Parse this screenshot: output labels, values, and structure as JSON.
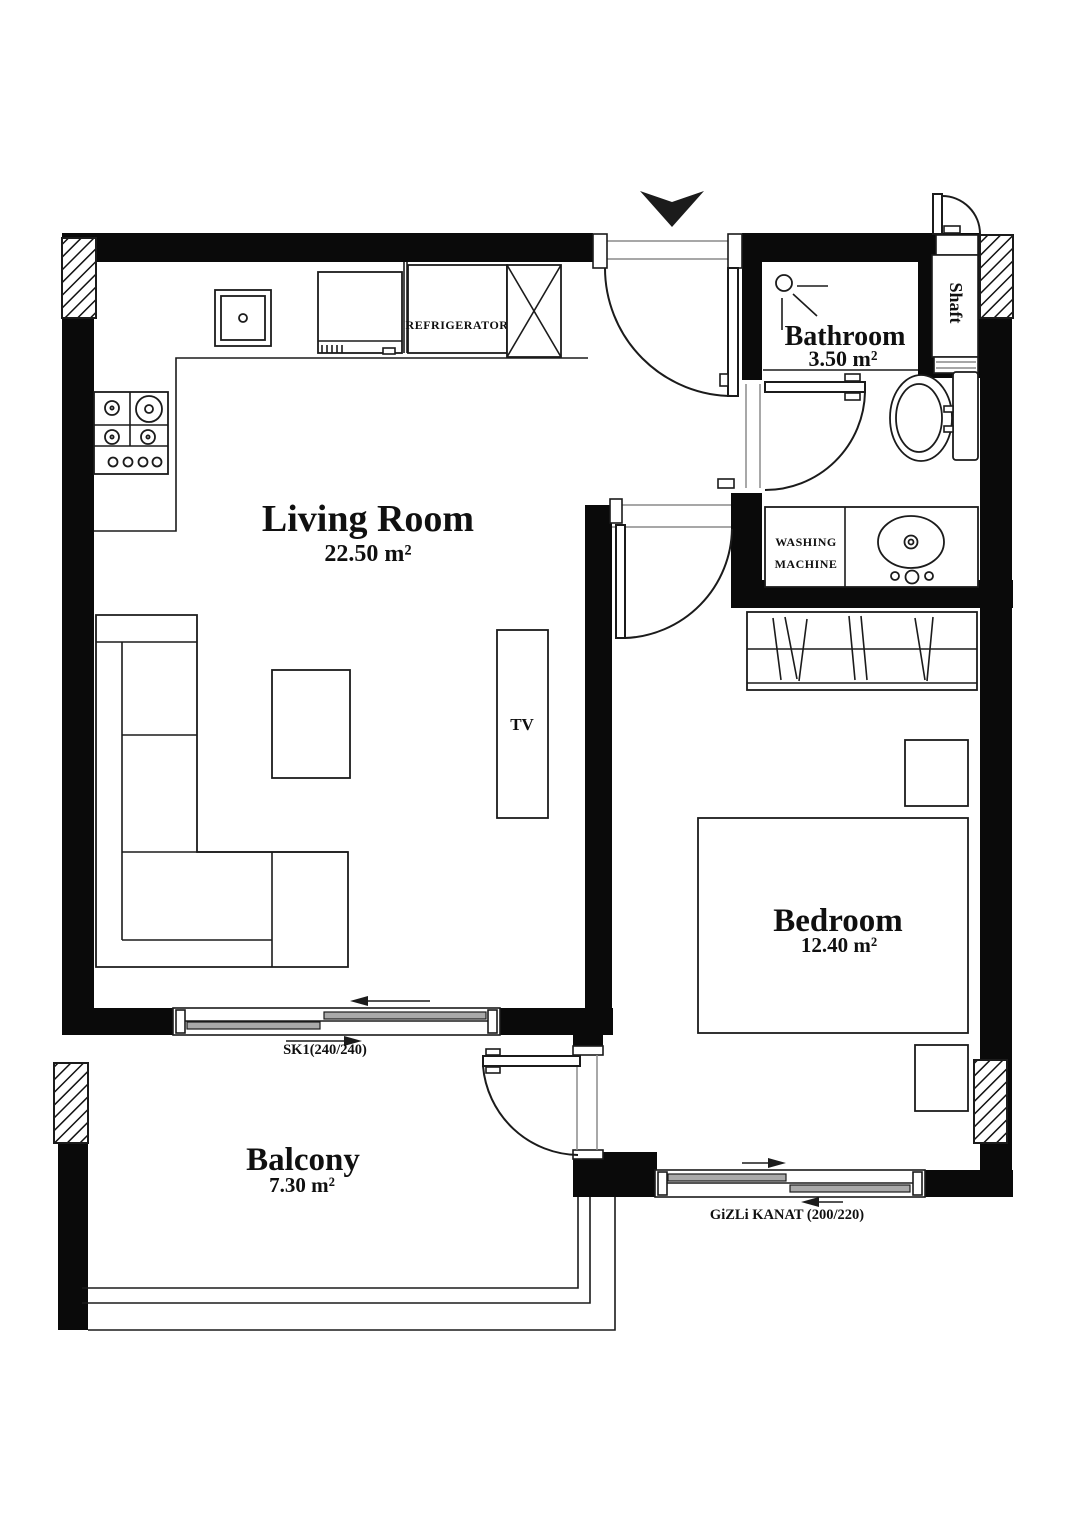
{
  "plan": {
    "rooms": {
      "living_room": {
        "name": "Living Room",
        "area": "22.50 m²"
      },
      "bedroom": {
        "name": "Bedroom",
        "area": "12.40 m²"
      },
      "bathroom": {
        "name": "Bathroom",
        "area": "3.50 m²"
      },
      "balcony": {
        "name": "Balcony",
        "area": "7.30 m²"
      },
      "shaft": {
        "name": "Shaft"
      }
    },
    "labels": {
      "refrigerator": "REFRIGERATOR",
      "tv": "TV",
      "washing_machine_line1": "WASHING",
      "washing_machine_line2": "MACHINE"
    },
    "windows": {
      "sk1": "SK1(240/240)",
      "gizli_kanat": "GiZLi KANAT (200/220)"
    },
    "colors": {
      "wall": "#0a0a0a",
      "line": "#1b1b1b",
      "pane_fill": "#a9a9a9",
      "sill": "#8a8a8a",
      "background": "#ffffff"
    }
  }
}
